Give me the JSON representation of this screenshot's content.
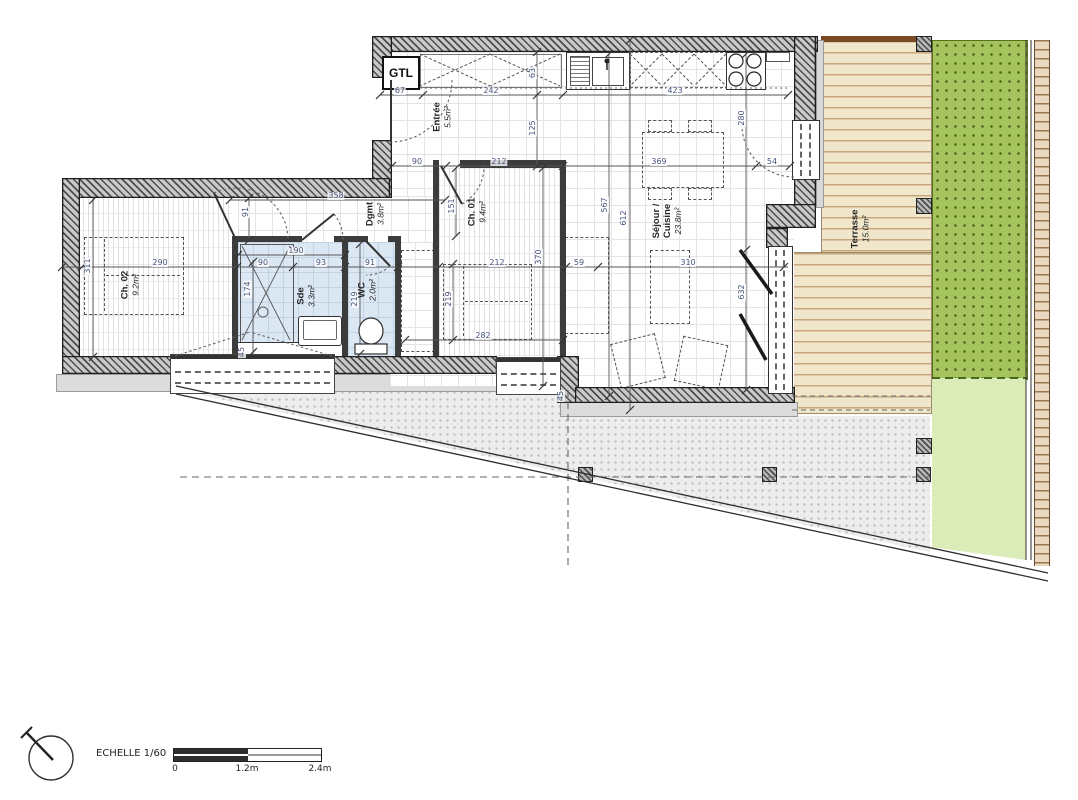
{
  "floorplan": {
    "rooms": [
      {
        "id": "ch02",
        "name_lines": [
          "Ch. 02"
        ],
        "area": "9.2m²",
        "x": 130,
        "y": 285
      },
      {
        "id": "sde",
        "name_lines": [
          "Sde"
        ],
        "area": "3.3m²",
        "x": 306,
        "y": 296
      },
      {
        "id": "wc",
        "name_lines": [
          "WC"
        ],
        "area": "2.0m²",
        "x": 367,
        "y": 290
      },
      {
        "id": "dgmt",
        "name_lines": [
          "Dgmt"
        ],
        "area": "3.8m²",
        "x": 375,
        "y": 214
      },
      {
        "id": "ch01",
        "name_lines": [
          "Ch. 01"
        ],
        "area": "9.4m²",
        "x": 477,
        "y": 212
      },
      {
        "id": "entree",
        "name_lines": [
          "Entrée"
        ],
        "area": "5.5m²",
        "x": 442,
        "y": 117
      },
      {
        "id": "sejour",
        "name_lines": [
          "Séjour /",
          "Cuisine"
        ],
        "area": "23.8m²",
        "x": 667,
        "y": 221
      },
      {
        "id": "terrasse",
        "name_lines": [
          "Terrasse"
        ],
        "area": "15.0m²",
        "x": 860,
        "y": 229
      }
    ],
    "dimensions": [
      {
        "t": "67",
        "x": 400,
        "y": 91,
        "v": 0
      },
      {
        "t": "242",
        "x": 491,
        "y": 91,
        "v": 0
      },
      {
        "t": "423",
        "x": 675,
        "y": 91,
        "v": 0
      },
      {
        "t": "63",
        "x": 533,
        "y": 73,
        "v": 1
      },
      {
        "t": "125",
        "x": 533,
        "y": 128,
        "v": 1
      },
      {
        "t": "90",
        "x": 417,
        "y": 162,
        "v": 0
      },
      {
        "t": "212",
        "x": 499,
        "y": 162,
        "v": 0
      },
      {
        "t": "369",
        "x": 659,
        "y": 162,
        "v": 0
      },
      {
        "t": "54",
        "x": 772,
        "y": 162,
        "v": 0
      },
      {
        "t": "280",
        "x": 742,
        "y": 118,
        "v": 1
      },
      {
        "t": "358",
        "x": 336,
        "y": 196,
        "v": 0
      },
      {
        "t": "91",
        "x": 246,
        "y": 212,
        "v": 1
      },
      {
        "t": "151",
        "x": 452,
        "y": 206,
        "v": 1
      },
      {
        "t": "190",
        "x": 296,
        "y": 251,
        "v": 0
      },
      {
        "t": "311",
        "x": 88,
        "y": 266,
        "v": 1
      },
      {
        "t": "290",
        "x": 160,
        "y": 263,
        "v": 0
      },
      {
        "t": "90",
        "x": 263,
        "y": 263,
        "v": 0
      },
      {
        "t": "93",
        "x": 321,
        "y": 263,
        "v": 0
      },
      {
        "t": "91",
        "x": 370,
        "y": 263,
        "v": 0
      },
      {
        "t": "212",
        "x": 497,
        "y": 263,
        "v": 0
      },
      {
        "t": "370",
        "x": 539,
        "y": 257,
        "v": 1
      },
      {
        "t": "59",
        "x": 579,
        "y": 263,
        "v": 0
      },
      {
        "t": "310",
        "x": 688,
        "y": 263,
        "v": 0
      },
      {
        "t": "174",
        "x": 248,
        "y": 289,
        "v": 1
      },
      {
        "t": "219",
        "x": 355,
        "y": 299,
        "v": 1
      },
      {
        "t": "219",
        "x": 449,
        "y": 299,
        "v": 1
      },
      {
        "t": "567",
        "x": 605,
        "y": 205,
        "v": 1
      },
      {
        "t": "612",
        "x": 624,
        "y": 218,
        "v": 1
      },
      {
        "t": "282",
        "x": 483,
        "y": 336,
        "v": 0
      },
      {
        "t": "45",
        "x": 242,
        "y": 352,
        "v": 1
      },
      {
        "t": "45",
        "x": 561,
        "y": 396,
        "v": 1
      },
      {
        "t": "632",
        "x": 742,
        "y": 292,
        "v": 1
      }
    ],
    "gtl_label": "GTL",
    "scale": {
      "label": "ECHELLE 1/60",
      "ticks": [
        "0",
        "1.2m",
        "2.4m"
      ]
    },
    "colors": {
      "wet_room": "#dbe7f3",
      "grass": "#a5c35c",
      "grass_light": "#dcecb9",
      "deck": "#f0e6cb",
      "gravel": "#ededed",
      "fence": "#ead9c0",
      "dim_text": "#47547e",
      "wall_dark": "#3c3c3c"
    }
  }
}
